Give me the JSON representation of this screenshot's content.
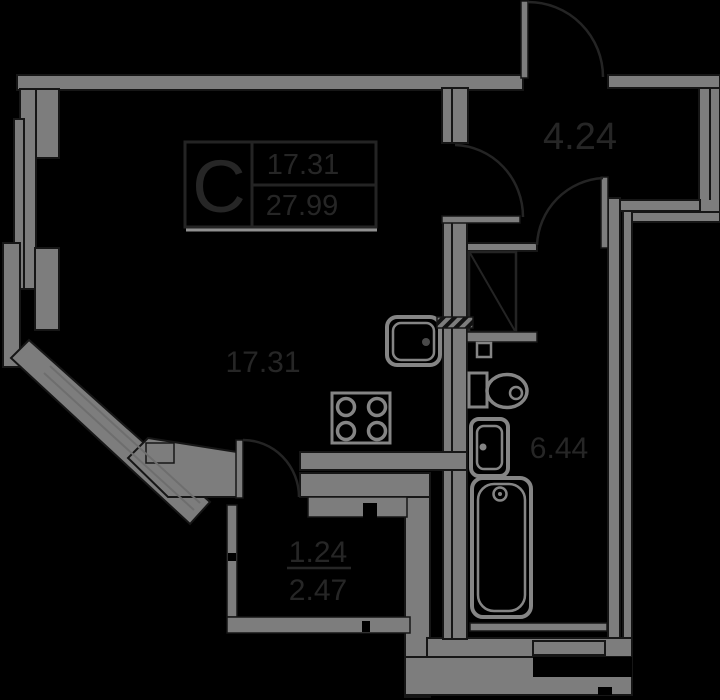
{
  "unit_stamp": {
    "type": "C",
    "living_area": "17.31",
    "total_area": "27.99"
  },
  "rooms": {
    "hallway": {
      "area": "4.24"
    },
    "living_room": {
      "area": "17.31"
    },
    "bathroom": {
      "area": "6.44"
    },
    "balcony": {
      "reduced_area": "1.24",
      "full_area": "2.47"
    }
  },
  "colors": {
    "background": "#000000",
    "wall_fill": "#7d7d7d",
    "wall_outline": "#161616",
    "fixture_line": "#858585",
    "annotation_line": "#242424",
    "label_text": "#262626",
    "stamp_underline": "#8f8f8f",
    "window_line": "#6e6e6e"
  }
}
